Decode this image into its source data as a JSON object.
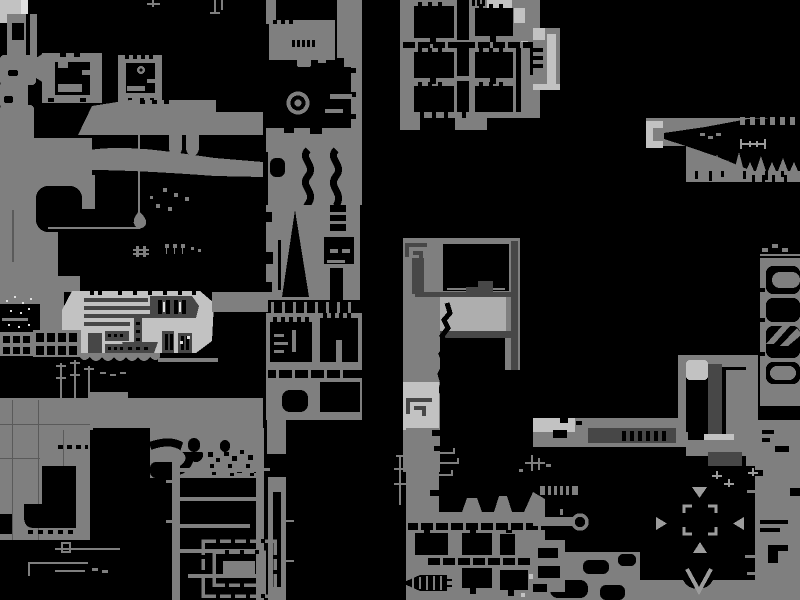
{
  "screen": {
    "type": "game-world-map",
    "width": 800,
    "height": 600,
    "style": "monochrome pixel-art map, black void with gray terrain"
  },
  "palette": {
    "bg": "#000000",
    "terrain": "#7f7f7f",
    "dark": "#474747",
    "light": "#c2c2c2",
    "bright": "#e0e0e0",
    "soft": "#aeaeae",
    "marker": "#9c9c9c",
    "hairline": "#5a5a5a"
  },
  "landmarks": [
    {
      "name": "eye-orb",
      "x": 298,
      "y": 103
    },
    {
      "name": "teardrop",
      "x": 140,
      "y": 219
    },
    {
      "name": "crashed-ship-platform",
      "x": 138,
      "y": 322
    },
    {
      "name": "spiral-vault",
      "x": 239,
      "y": 568
    },
    {
      "name": "whale-cavern",
      "x": 723,
      "y": 150
    },
    {
      "name": "compass-marker",
      "x": 700,
      "y": 522
    },
    {
      "name": "room-grid-northeast",
      "x": 470,
      "y": 60
    },
    {
      "name": "keep-structure",
      "x": 460,
      "y": 300
    },
    {
      "name": "tower-structure",
      "x": 718,
      "y": 410
    },
    {
      "name": "cell-frame-east",
      "x": 780,
      "y": 330
    },
    {
      "name": "ladder-shaft",
      "x": 218,
      "y": 520
    },
    {
      "name": "ring-port",
      "x": 580,
      "y": 522
    }
  ]
}
